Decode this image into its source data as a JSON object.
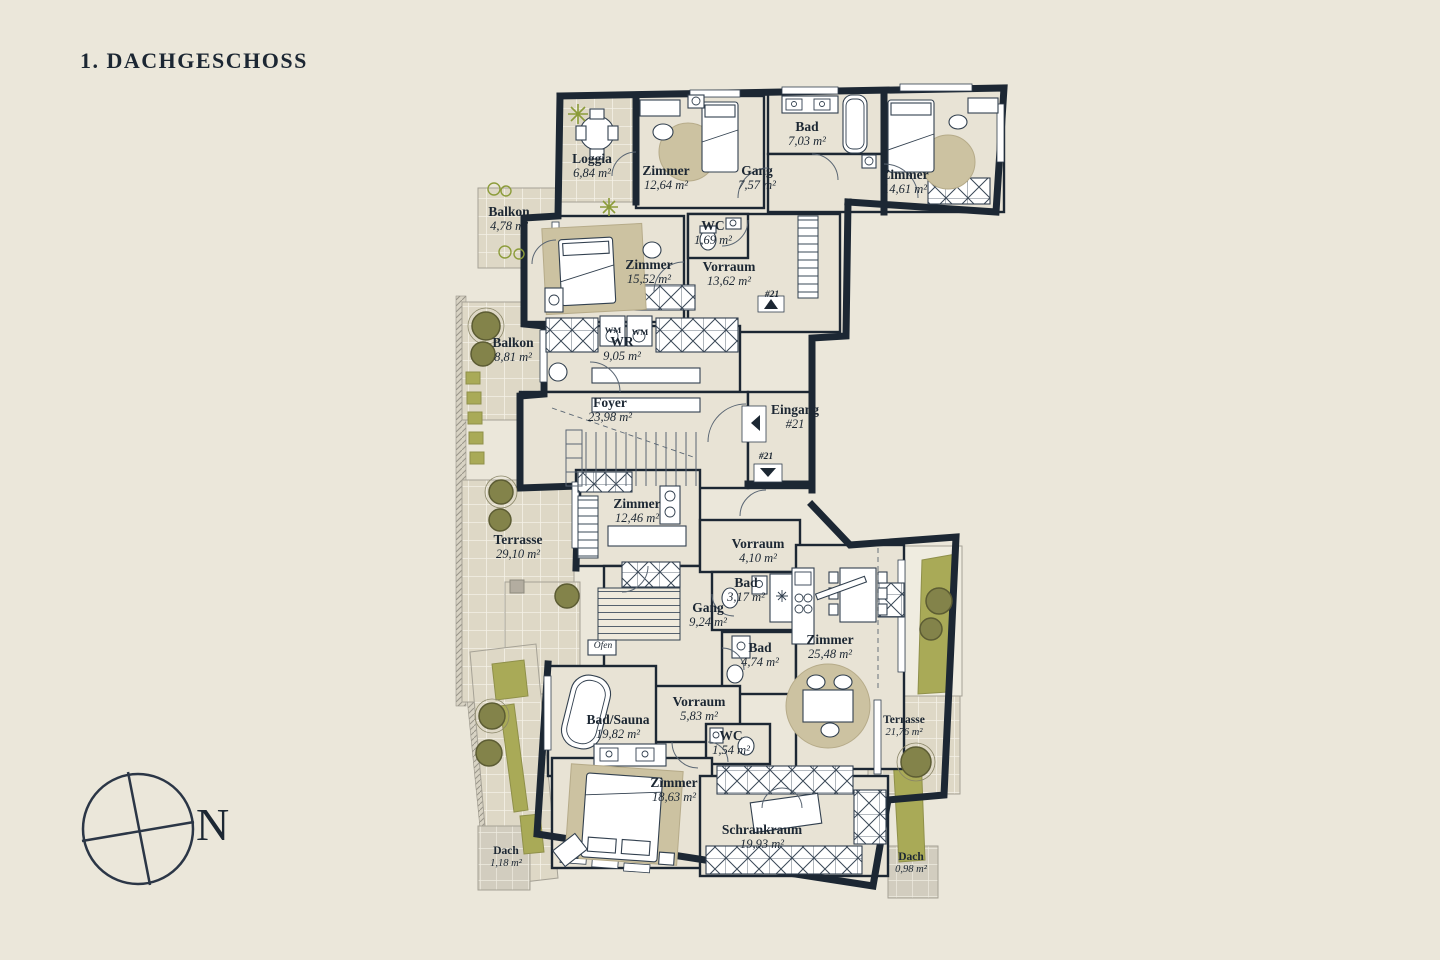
{
  "page": {
    "title": "1. DACHGESCHOSS"
  },
  "palette": {
    "background": "#ebe7da",
    "wall": "#1c2733",
    "floor": "#e8e3d5",
    "outdoor_tile": "#ded8c6",
    "rug": "#ccc2a1",
    "planter_green": "#a9aa57",
    "plant_pot": "#83834a",
    "text": "#1c2733"
  },
  "compass": {
    "label": "N"
  },
  "rooms": [
    {
      "name": "Loggia",
      "area": "6,84 m²",
      "x": 592,
      "y": 152
    },
    {
      "name": "Zimmer",
      "area": "12,64 m²",
      "x": 666,
      "y": 164
    },
    {
      "name": "Bad",
      "area": "7,03 m²",
      "x": 807,
      "y": 120
    },
    {
      "name": "Gang",
      "area": "7,57 m²",
      "x": 757,
      "y": 164
    },
    {
      "name": "Zimmer",
      "area": "14,61 m²",
      "x": 905,
      "y": 168
    },
    {
      "name": "WC",
      "area": "1,69 m²",
      "x": 713,
      "y": 219
    },
    {
      "name": "Balkon",
      "area": "4,78 m²",
      "x": 509,
      "y": 205
    },
    {
      "name": "Zimmer",
      "area": "15,52 m²",
      "x": 649,
      "y": 258
    },
    {
      "name": "Vorraum",
      "area": "13,62 m²",
      "x": 729,
      "y": 260
    },
    {
      "name": "Balkon",
      "area": "8,81 m²",
      "x": 513,
      "y": 336
    },
    {
      "name": "WR",
      "area": "9,05 m²",
      "x": 622,
      "y": 335
    },
    {
      "name": "Foyer",
      "area": "23,98 m²",
      "x": 610,
      "y": 396
    },
    {
      "name": "Eingang",
      "area": "#21",
      "x": 795,
      "y": 403
    },
    {
      "name": "Zimmer",
      "area": "12,46 m²",
      "x": 637,
      "y": 497
    },
    {
      "name": "Terrasse",
      "area": "29,10 m²",
      "x": 518,
      "y": 533
    },
    {
      "name": "Vorraum",
      "area": "4,10 m²",
      "x": 758,
      "y": 537
    },
    {
      "name": "Bad",
      "area": "3,17 m²",
      "x": 746,
      "y": 576
    },
    {
      "name": "Gang",
      "area": "9,24 m²",
      "x": 708,
      "y": 601
    },
    {
      "name": "Bad",
      "area": "4,74 m²",
      "x": 760,
      "y": 641
    },
    {
      "name": "Zimmer",
      "area": "25,48 m²",
      "x": 830,
      "y": 633
    },
    {
      "name": "Vorraum",
      "area": "5,83 m²",
      "x": 699,
      "y": 695
    },
    {
      "name": "WC",
      "area": "1,54 m²",
      "x": 731,
      "y": 729
    },
    {
      "name": "Bad/Sauna",
      "area": "19,82 m²",
      "x": 618,
      "y": 713
    },
    {
      "name": "Terrasse",
      "area": "21,76 m²",
      "x": 904,
      "y": 714,
      "small": true
    },
    {
      "name": "Zimmer",
      "area": "18,63 m²",
      "x": 674,
      "y": 776
    },
    {
      "name": "Schrankraum",
      "area": "19,93 m²",
      "x": 762,
      "y": 823
    },
    {
      "name": "Dach",
      "area": "1,18 m²",
      "x": 506,
      "y": 845,
      "small": true
    },
    {
      "name": "Dach",
      "area": "0,98 m²",
      "x": 911,
      "y": 851,
      "small": true
    }
  ],
  "markers": [
    {
      "label": "#21",
      "x": 772,
      "y": 290
    },
    {
      "label": "#21",
      "x": 766,
      "y": 452
    }
  ],
  "appliance_labels": [
    {
      "label": "WM",
      "x": 613,
      "y": 325
    },
    {
      "label": "WM",
      "x": 640,
      "y": 327
    },
    {
      "label": "Ofen",
      "x": 603,
      "y": 641,
      "italic": true
    }
  ]
}
